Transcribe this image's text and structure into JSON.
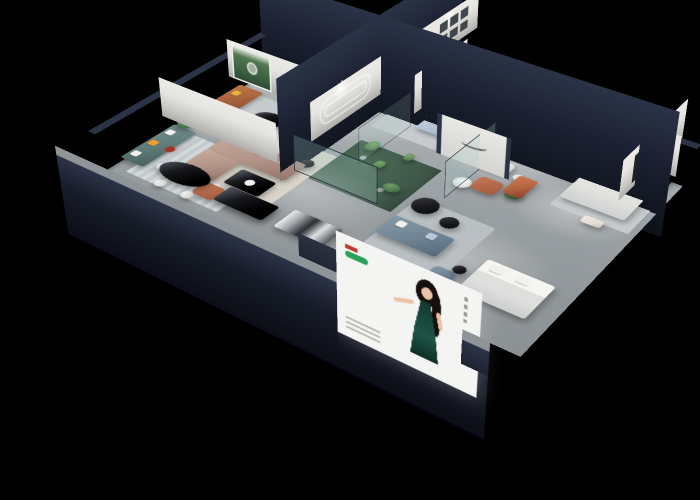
{
  "meta": {
    "title": "Furniture showroom - 3D isometric cutaway floor plan render",
    "description": "Cutaway 3D isometric render of a furniture showroom on a black background: sofa display rooms along two back walls, a green arched-niche wall, gallery frames, a glass cactus atrium at center, black oval dining set with white chairs and a red sculptural lamp, navy outer walls and plinth, and an illuminated facade poster of a woman in a green dress."
  },
  "labels": {
    "room_gallery": "lounge with gallery wall and brown sofa",
    "room_leather": "leather sofa room with forest mural and red arch niche",
    "room_teal": "teal sofa lounge with racetrack wall deco",
    "room_arches": "green arched-wall lounge with white armchairs and blue sofa",
    "room_white_sofa": "white sofa room with red frame grid",
    "room_bedroom": "bedroom display with media wall",
    "atrium": "glass-enclosed cactus atrium",
    "zone_sectional": "taupe sectional sofa zone",
    "zone_dining": "black oval dining table with white chairs and red lamp",
    "zone_slate": "slate-blue sofa zone with round black tables",
    "zone_bed_front": "front bed display",
    "zone_displays": "black island and chrome display benches",
    "poster": "illuminated facade poster of woman in green dress",
    "logo_wall": "partition wall with cursive brand mark"
  },
  "colors": {
    "bg": "#000000",
    "navy": "#2b3347",
    "navyDeep": "#0d1119",
    "wall": "#e6e5e1",
    "wallShade": "#aeadaa",
    "greenWall": "#8ba093",
    "floorLight": "#b6babc",
    "floorDark": "#8a9093",
    "rug": "#c6cbce",
    "rugCream": "#d9d4c9",
    "rugBlue": "#b7c6d0",
    "teal": "#5e7c79",
    "leather": "#a05c38",
    "brown": "#9a6247",
    "taupe": "#b49488",
    "blue": "#aebfd2",
    "slate": "#6f8494",
    "white": "#eceae6",
    "cream": "#e3ddd4",
    "black": "#17181c",
    "orange": "#f09f2e",
    "yellow": "#e8b13a",
    "red": "#a23324",
    "rust": "#b4633f",
    "plant": "#4c7a50",
    "cactus": "#5d8a57",
    "atriumFloor": "#40594a",
    "glass": "rgba(165,205,198,0.25)",
    "skin": "#eac3a4",
    "dress": "#1e5446",
    "posterWhite": "#f4f4f2",
    "brandGreen": "#2aa05a",
    "brandRed": "#c0392b"
  }
}
